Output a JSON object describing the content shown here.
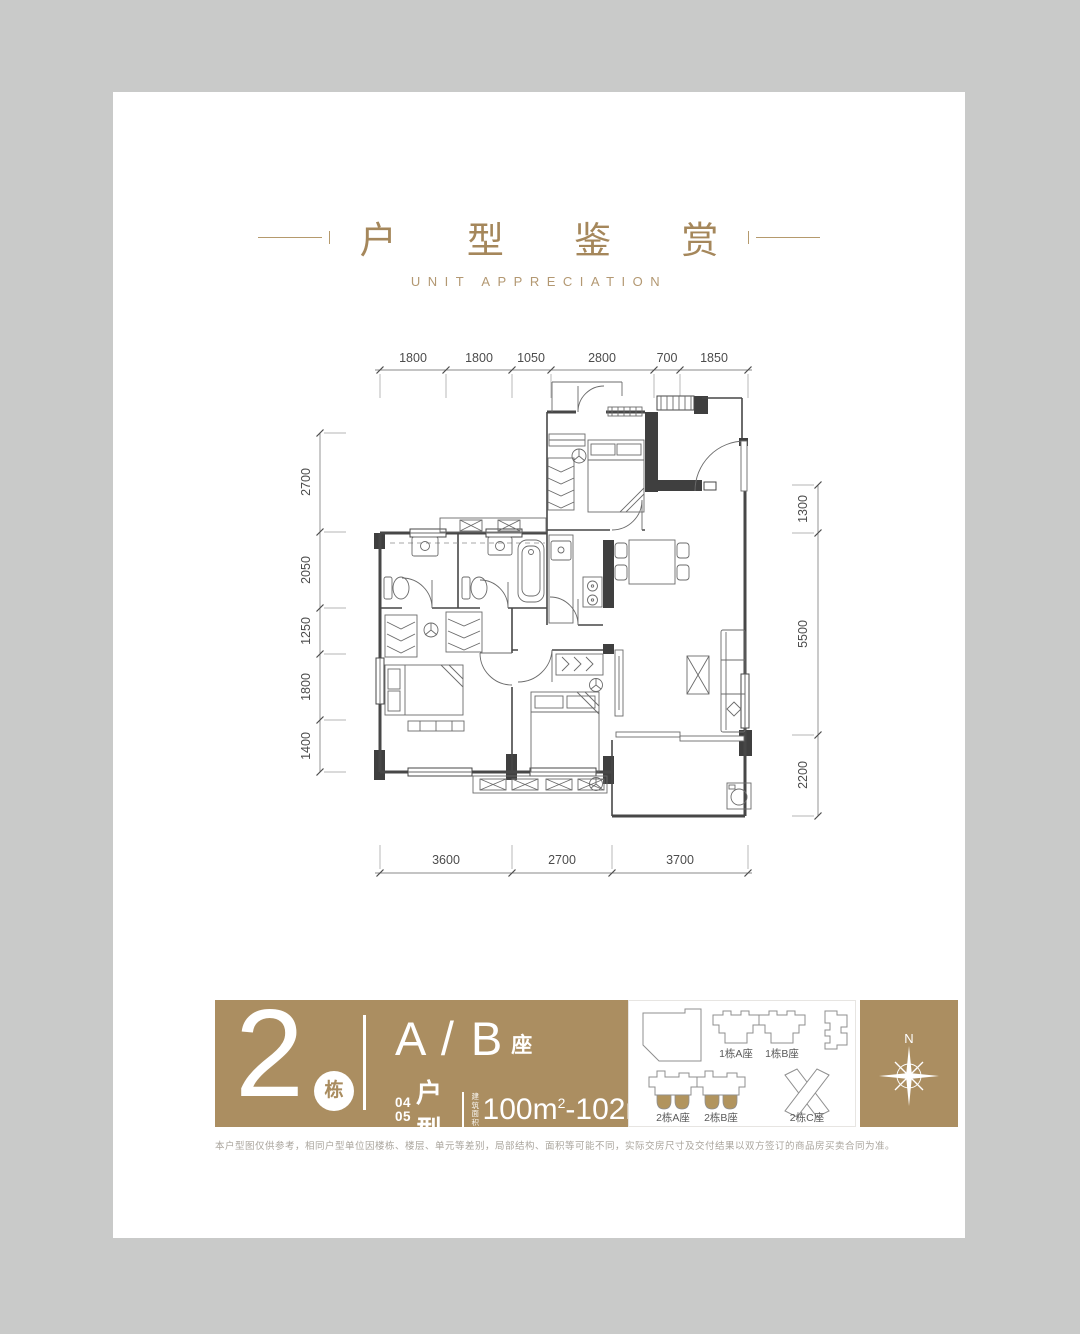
{
  "header": {
    "title": "户 型 鉴 赏",
    "subtitle": "UNIT APPRECIATION"
  },
  "floorplan": {
    "top_dims": [
      "1800",
      "1800",
      "1050",
      "2800",
      "700",
      "1850"
    ],
    "left_dims": [
      "2700",
      "2050",
      "1250",
      "1800",
      "1400"
    ],
    "right_dims": [
      "1300",
      "5500",
      "2200"
    ],
    "bottom_dims": [
      "3600",
      "2700",
      "3700"
    ]
  },
  "unit_card": {
    "building_number": "2",
    "building_unit": "栋",
    "block_title": "A / B",
    "block_suffix": "座",
    "type_no_top": "04",
    "type_no_bottom": "05",
    "type_label": "户型",
    "area_label": "建筑面积",
    "area_v1": "100m",
    "area_sup1": "2",
    "area_sep": "-",
    "area_v2": "102m",
    "area_sup2": "2"
  },
  "site_key": {
    "labels": [
      "1栋A座",
      "1栋B座",
      "2栋A座",
      "2栋B座",
      "2栋C座"
    ]
  },
  "compass": {
    "north": "N"
  },
  "disclaimer": "本户型图仅供参考，相同户型单位因楼栋、楼层、单元等差别，局部结构、面积等可能不同，实际交房尺寸及交付结果以双方签订的商品房买卖合同为准。",
  "colors": {
    "gold_band": "#ab8e61",
    "gold_title": "#a5875b",
    "wall": "#3f3f3f",
    "page_bg": "#c9cac9"
  }
}
